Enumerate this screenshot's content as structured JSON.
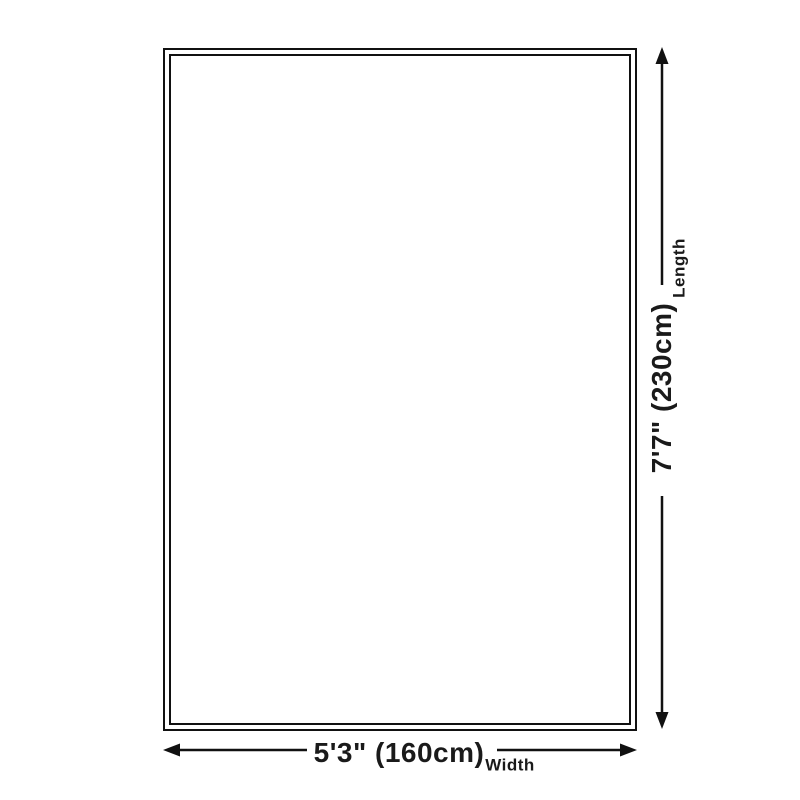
{
  "page": {
    "background_color": "#ffffff",
    "line_color": "#111111",
    "text_color": "#1a1a1a"
  },
  "diagram": {
    "kind": "rug-size-dimension-diagram",
    "rug": {
      "shape": "rectangle",
      "border_style": "double-line",
      "fill": "#ffffff"
    },
    "length_dimension": {
      "value": "7'7\" (230cm)",
      "axis_label": "Length",
      "arrow": "vertical-double-headed"
    },
    "width_dimension": {
      "value": "5'3\" (160cm)",
      "axis_label": "Width",
      "arrow": "horizontal-double-headed"
    }
  }
}
